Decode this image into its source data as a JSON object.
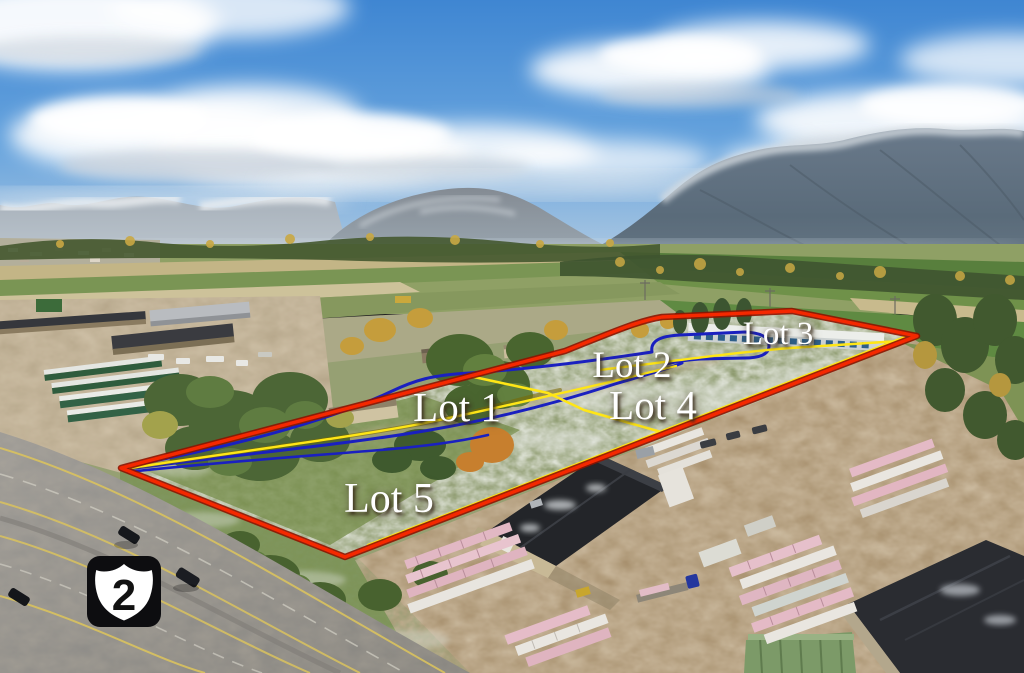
{
  "annotations": {
    "lots": [
      {
        "id": "lot-1",
        "label": "Lot 1",
        "x": 457,
        "y": 421,
        "size": 41
      },
      {
        "id": "lot-2",
        "label": "Lot 2",
        "x": 632,
        "y": 377,
        "size": 37
      },
      {
        "id": "lot-3",
        "label": "Lot 3",
        "x": 778,
        "y": 344,
        "size": 33
      },
      {
        "id": "lot-4",
        "label": "Lot 4",
        "x": 653,
        "y": 419,
        "size": 41
      },
      {
        "id": "lot-5",
        "label": "Lot 5",
        "x": 389,
        "y": 512,
        "size": 42
      }
    ],
    "route_shield": {
      "number": "2"
    },
    "colors": {
      "boundary": "#f52800",
      "boundary_edge": "#8e1300",
      "lot_line": "#ffe616",
      "lot_line_edge": "#7a6800",
      "road_line": "#1a20c0",
      "label_text": "#ffffff",
      "shield_bg": "#0d0d10",
      "shield_face": "#ffffff",
      "shield_number": "#111111"
    }
  }
}
